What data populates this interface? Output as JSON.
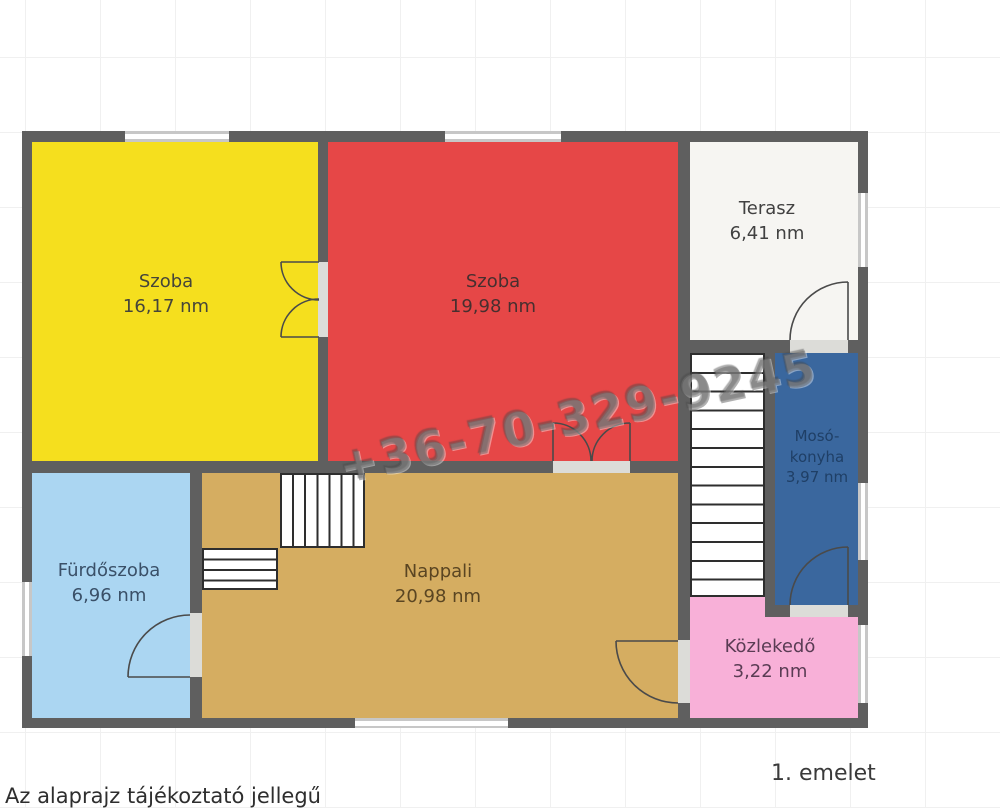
{
  "page": {
    "footnote": "Az alaprajz tájékoztató jellegű",
    "floor_label": "1. emelet"
  },
  "watermark": {
    "text": "+36-70-329-9245"
  },
  "rooms": [
    {
      "id": "szoba-1",
      "name": "Szoba",
      "area": "16,17 nm",
      "color": "#f5df1e",
      "text_color": "#45453a"
    },
    {
      "id": "szoba-2",
      "name": "Szoba",
      "area": "19,98 nm",
      "color": "#e64747",
      "text_color": "#472f2f"
    },
    {
      "id": "terasz",
      "name": "Terasz",
      "area": "6,41 nm",
      "color": "#f6f5f2",
      "text_color": "#414141"
    },
    {
      "id": "moso-konyha",
      "name": "Mosó-konyha",
      "line1": "Mosó-",
      "line2": "konyha",
      "area": "3,97 nm",
      "color": "#3a679e",
      "text_color": "#1f3f66"
    },
    {
      "id": "furdoszoba",
      "name": "Fürdőszoba",
      "area": "6,96 nm",
      "color": "#abd6f2",
      "text_color": "#3a5068"
    },
    {
      "id": "nappali",
      "name": "Nappali",
      "area": "20,98 nm",
      "color": "#d5ad61",
      "text_color": "#5a4522"
    },
    {
      "id": "kozlekedo",
      "name": "Közlekedő",
      "area": "3,22 nm",
      "color": "#f8b0d8",
      "text_color": "#5a3c54"
    }
  ],
  "colors": {
    "wall": "#5f5f5f",
    "window": "#c7c7c7",
    "door_leaf": "#dcdcd8",
    "stair_border": "#2e2e2e",
    "door_arc": "#4a4a4a"
  }
}
